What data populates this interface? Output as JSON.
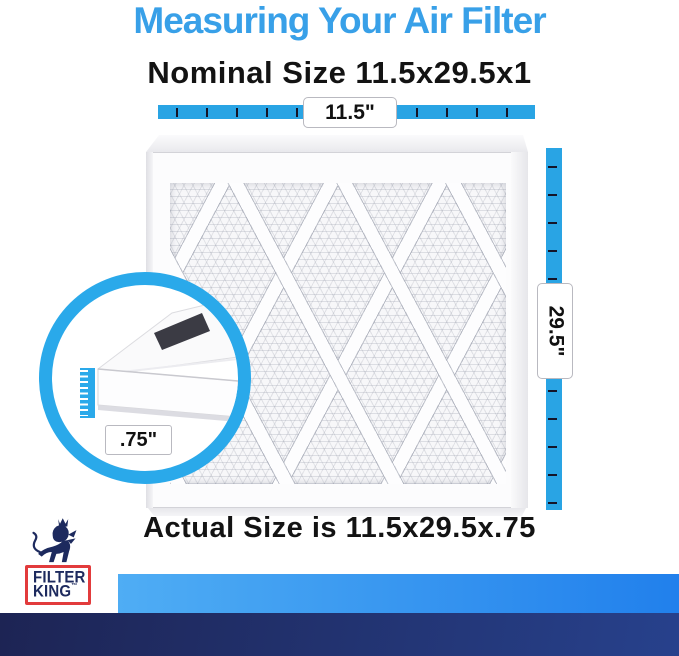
{
  "header": {
    "title": "Measuring Your Air Filter",
    "nominal": "Nominal Size 11.5x29.5x1"
  },
  "measurements": {
    "width": "11.5\"",
    "height": "29.5\"",
    "depth": ".75\""
  },
  "footer": {
    "actual": "Actual Size is 11.5x29.5x.75"
  },
  "logo": {
    "line1": "FILTER",
    "line2": "KING",
    "tm": "™",
    "lion_icon": "lion-with-crown-icon"
  },
  "colors": {
    "title_blue": "#38a0e8",
    "ruler_blue": "#29a4e4",
    "circle_blue": "#2aa9ea",
    "bar_light_start": "#4fadf4",
    "bar_light_end": "#2180ec",
    "bar_navy_start": "#1d2454",
    "bar_navy_end": "#27418c",
    "logo_red": "#e23b3c",
    "logo_navy": "#1d2a5e"
  }
}
